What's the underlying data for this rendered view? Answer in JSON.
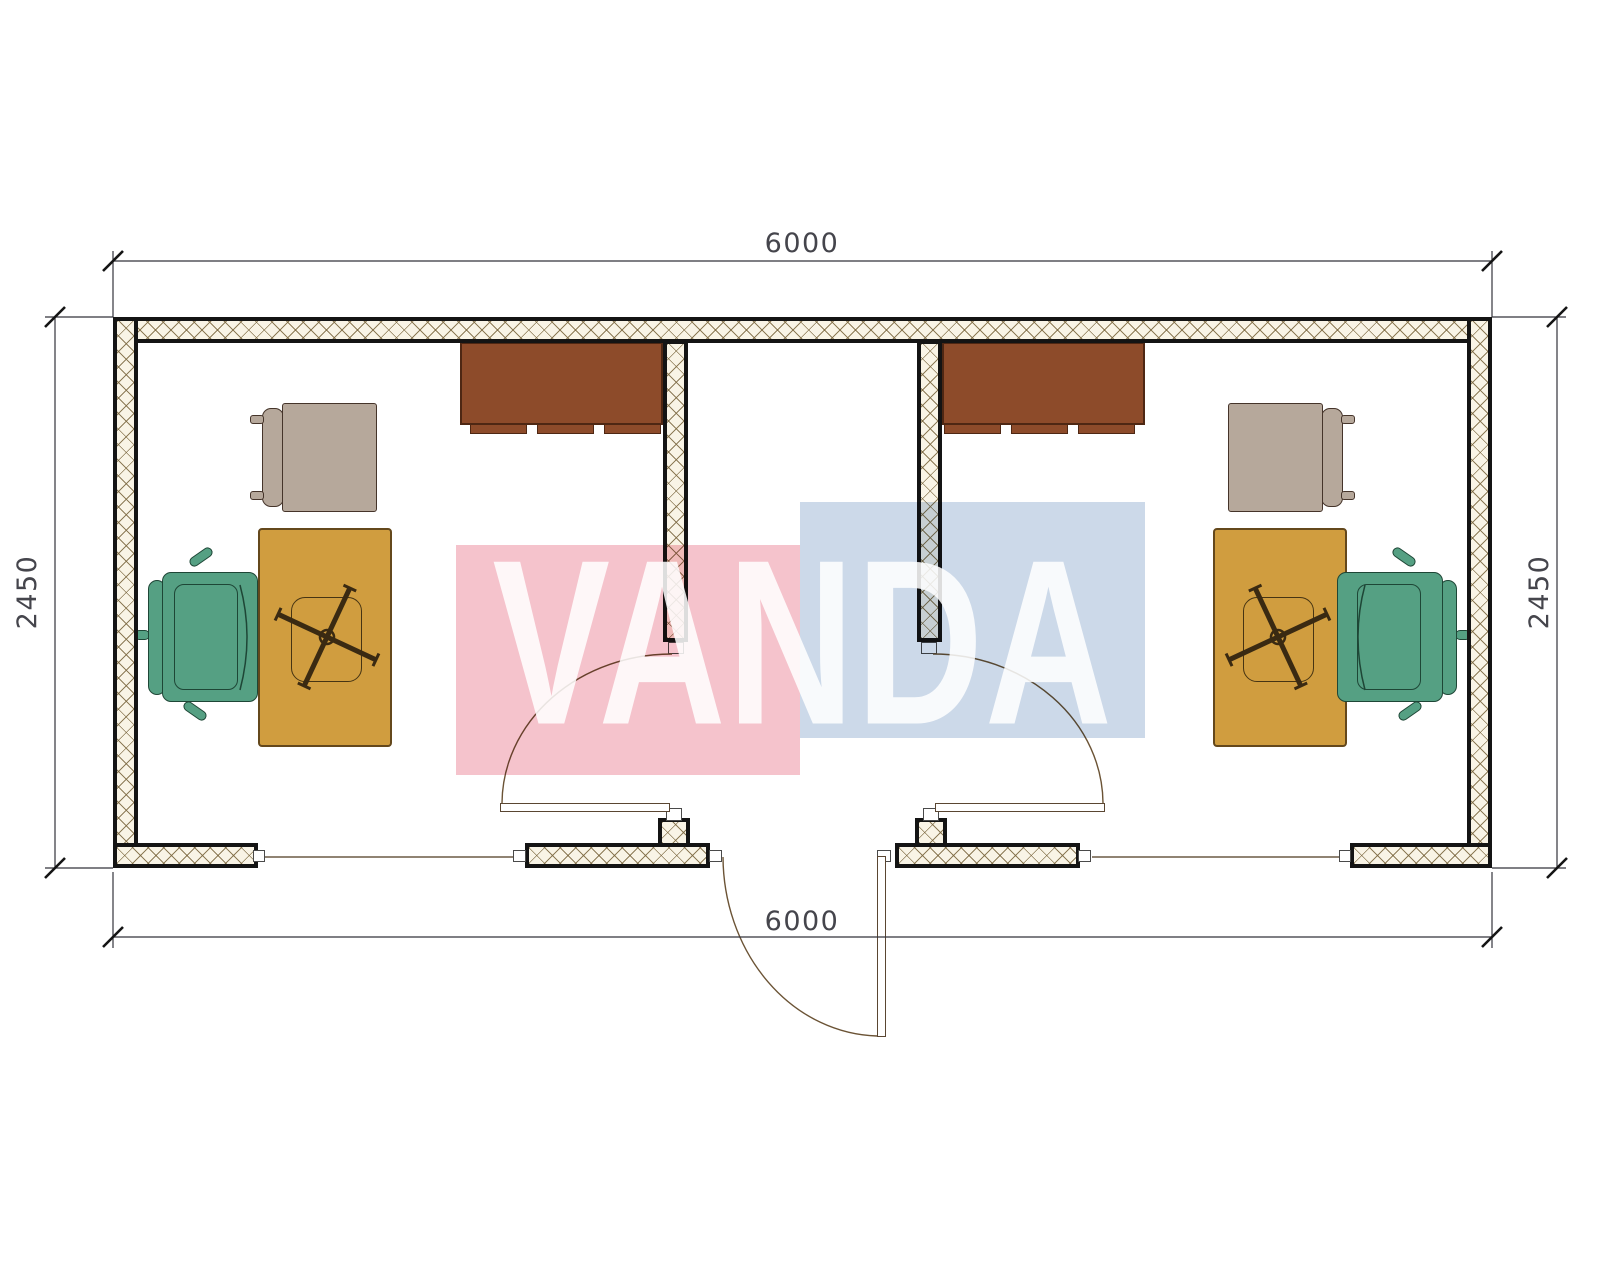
{
  "title": "office-container-floor-plan",
  "watermark": {
    "text": "VANDA"
  },
  "dimensions": {
    "top": "6000",
    "bottom": "6000",
    "left": "2450",
    "right": "2450"
  },
  "colors": {
    "pink": "#f5c3cc",
    "blue": "#ccd9e9",
    "desk": "#d09d3f",
    "chair": "#55a083",
    "visitor": "#b6a89b",
    "cabinet": "#8d4b2a",
    "dimline": "#33333b",
    "doorarc": "#6b5335"
  }
}
